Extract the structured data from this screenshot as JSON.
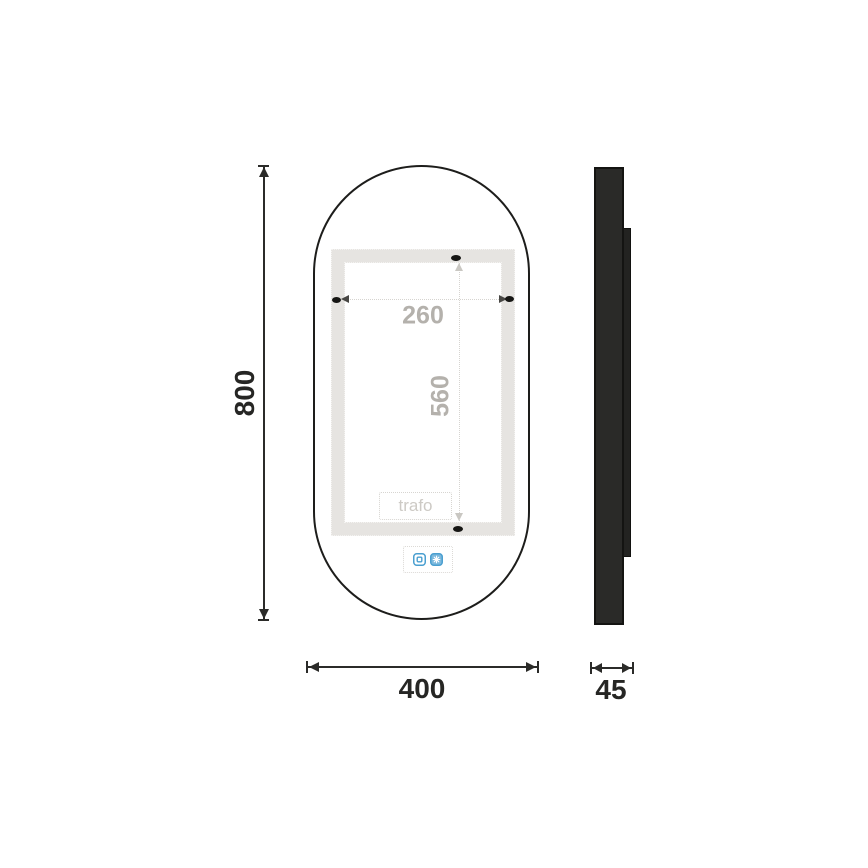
{
  "drawing": {
    "title": "Oval LED mirror dimension drawing",
    "front_view": {
      "overall_height_label": "800",
      "overall_width_label": "400",
      "inner_width_label": "260",
      "inner_height_label": "560",
      "trafo_label": "trafo",
      "icons": [
        "touch-sensor-icon",
        "anti-fog-icon"
      ]
    },
    "side_view": {
      "depth_label": "45"
    },
    "colors": {
      "outline": "#1d1d1b",
      "dimension_line": "#2b2b29",
      "dark_label": "#262624",
      "gray_label": "#b4b1ac",
      "led_band": "#e6e4e1",
      "dotted_line": "#d6d4d0",
      "side_panel_fill": "#2a2a28",
      "accent_blue": "#4a9fd0"
    }
  }
}
